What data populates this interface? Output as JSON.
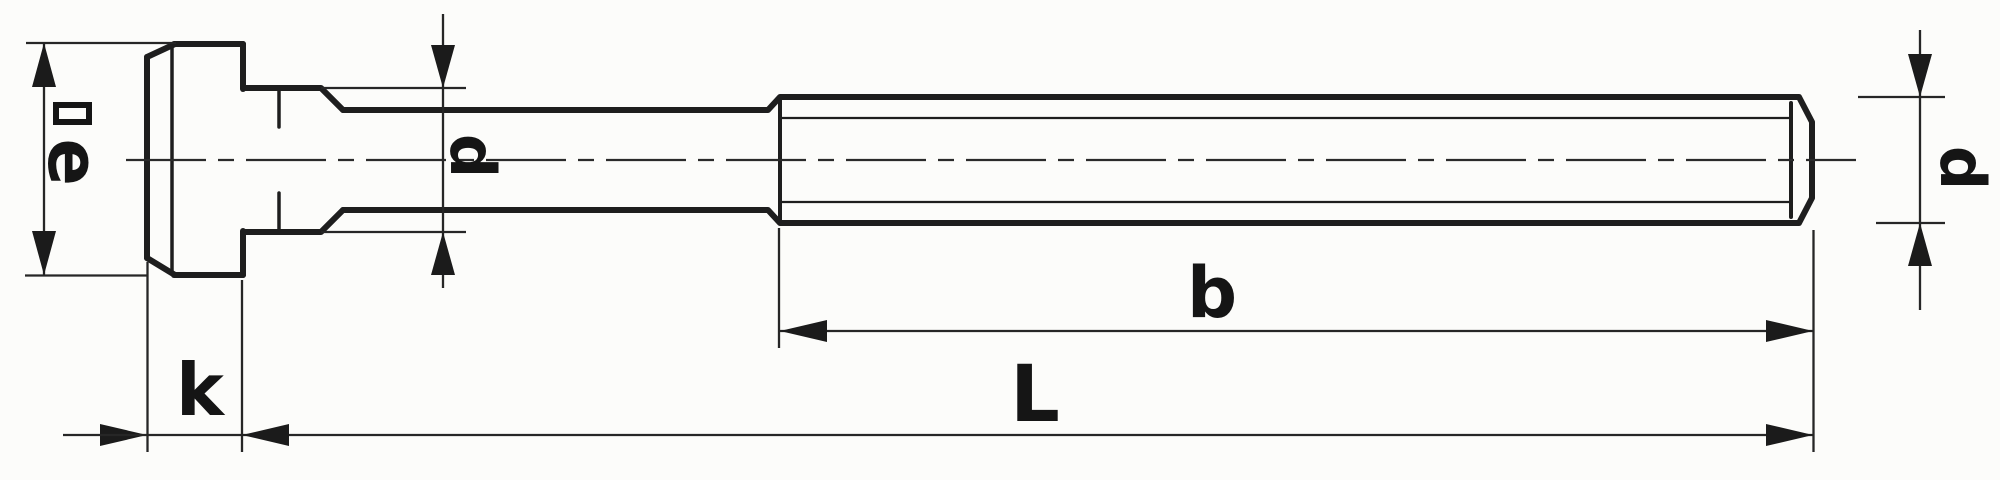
{
  "drawing": {
    "description": "Technical line drawing of a T-slot bolt (side view) with dimension labels",
    "background_color": "#fcfcfa",
    "line_color": "#1e1e1e",
    "dimension_line_color": "#262626"
  },
  "dimension_labels": {
    "head_size": {
      "symbol": "square",
      "letter": "e"
    },
    "head_height": {
      "letter": "k"
    },
    "shank_diameter": {
      "letter": "d"
    },
    "thread_diameter": {
      "letter": "d"
    },
    "thread_length": {
      "letter": "b"
    },
    "total_length": {
      "letter": "L"
    }
  }
}
